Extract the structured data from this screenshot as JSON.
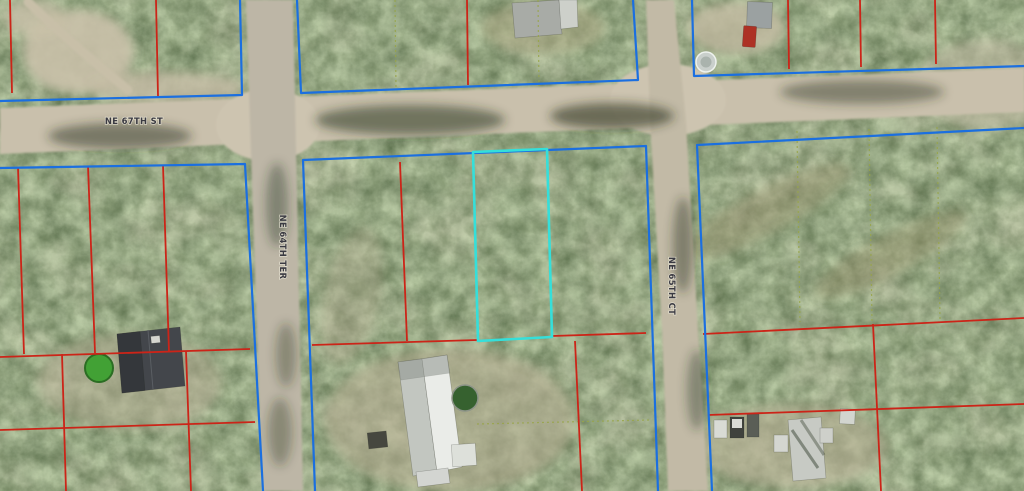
{
  "map": {
    "street_labels": [
      {
        "id": "ne-67th-st",
        "text": "NE 67TH ST",
        "orientation": "horizontal"
      },
      {
        "id": "ne-64th-ter",
        "text": "NE 64TH TER",
        "orientation": "vertical"
      },
      {
        "id": "ne-65th-ct",
        "text": "NE 65TH CT",
        "orientation": "vertical"
      }
    ],
    "overlay_colors": {
      "parcel_boundary_blue": "#1b6fe0",
      "lot_line_red": "#cc2418",
      "subject_parcel_cyan": "#35dfda",
      "dashed_lot_line_green": "#98a448"
    }
  }
}
